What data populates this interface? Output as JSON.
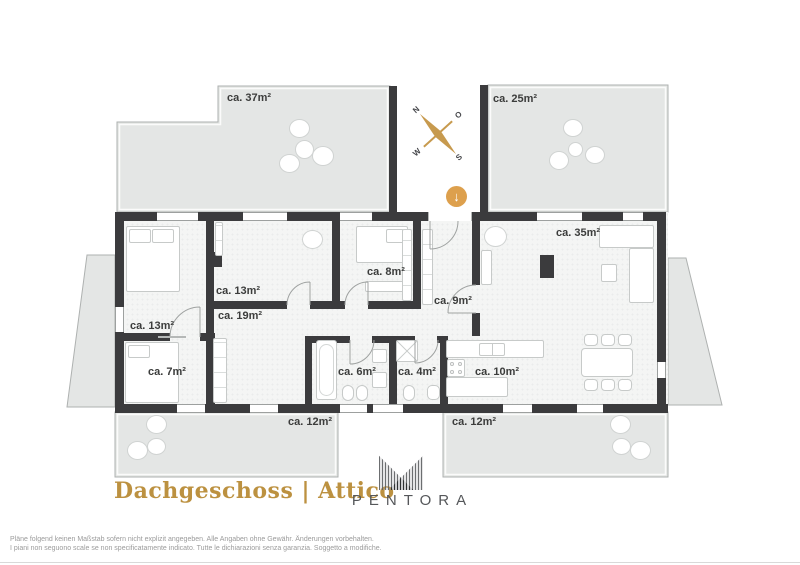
{
  "title": {
    "text": "Dachgeschoss | Attico"
  },
  "brand": {
    "name": "PENTORA"
  },
  "compass": {
    "n": "N",
    "e": "O",
    "s": "S",
    "w": "W"
  },
  "stairs": {
    "glyph": "↓"
  },
  "footer": {
    "line1": "Pläne folgend keinen Maßstab sofern nicht explizit angegeben. Alle Angaben ohne Gewähr. Änderungen vorbehalten.",
    "line2": "I piani non seguono scale se non specificatamente indicato. Tutte le dichiarazioni senza garanzia. Soggetto a modifiche."
  },
  "rooms": [
    {
      "name": "terrace-top-left",
      "label": "ca. 37m²"
    },
    {
      "name": "terrace-top-right",
      "label": "ca. 25m²"
    },
    {
      "name": "living-room",
      "label": "ca. 35m²"
    },
    {
      "name": "bedroom-middle",
      "label": "ca. 13m²"
    },
    {
      "name": "bedroom-small",
      "label": "ca. 8m²"
    },
    {
      "name": "corridor",
      "label": "ca. 9m²"
    },
    {
      "name": "hallway",
      "label": "ca. 19m²"
    },
    {
      "name": "bedroom-left",
      "label": "ca. 13m²"
    },
    {
      "name": "room-7",
      "label": "ca. 7m²"
    },
    {
      "name": "bathroom-6",
      "label": "ca. 6m²"
    },
    {
      "name": "bathroom-4",
      "label": "ca. 4m²"
    },
    {
      "name": "kitchen",
      "label": "ca. 10m²"
    },
    {
      "name": "terrace-bottom-left",
      "label": "ca. 12m²"
    },
    {
      "name": "terrace-bottom-right",
      "label": "ca. 12m²"
    }
  ],
  "colors": {
    "accent_gold": "#bc9140",
    "wall": "#3b3b3d",
    "terrace_fill": "#e4e6e5",
    "plant_green": "#9dbda9",
    "compass_gold": "#c79a4e",
    "arrow_bg": "#dda04d"
  }
}
